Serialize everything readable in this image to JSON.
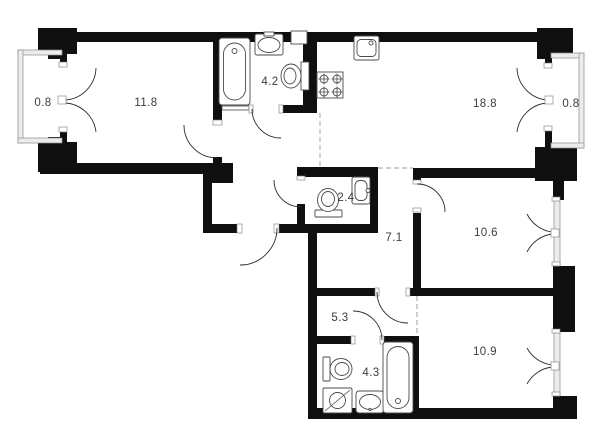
{
  "plan": {
    "type": "apartment-floor-plan",
    "rooms": [
      {
        "name": "balcony-left",
        "area": "0.8"
      },
      {
        "name": "living-room",
        "area": "11.8"
      },
      {
        "name": "bathroom-top",
        "area": "4.2"
      },
      {
        "name": "kitchen-living",
        "area": "18.8"
      },
      {
        "name": "balcony-right",
        "area": "0.8"
      },
      {
        "name": "wc",
        "area": "2.4"
      },
      {
        "name": "hallway",
        "area": "7.1"
      },
      {
        "name": "bedroom-right",
        "area": "10.6"
      },
      {
        "name": "corridor",
        "area": "5.3"
      },
      {
        "name": "bathroom-bottom",
        "area": "4.3"
      },
      {
        "name": "bedroom-bottom",
        "area": "10.9"
      }
    ],
    "fixtures": [
      {
        "name": "bathtub",
        "room": "bathroom-top"
      },
      {
        "name": "wash-basin",
        "room": "bathroom-top"
      },
      {
        "name": "toilet",
        "room": "bathroom-top"
      },
      {
        "name": "vent-shaft",
        "room": "bathroom-top"
      },
      {
        "name": "kitchen-sink",
        "room": "kitchen-living"
      },
      {
        "name": "stove-4-burner",
        "room": "kitchen-living"
      },
      {
        "name": "toilet",
        "room": "wc"
      },
      {
        "name": "wash-basin",
        "room": "wc"
      },
      {
        "name": "toilet",
        "room": "bathroom-bottom"
      },
      {
        "name": "washing-machine",
        "room": "bathroom-bottom"
      },
      {
        "name": "wash-basin",
        "room": "bathroom-bottom"
      },
      {
        "name": "bathtub",
        "room": "bathroom-bottom"
      }
    ],
    "colors": {
      "wall": "#0f0f0f",
      "line": "#2b2b2b",
      "label": "#3c3c3c",
      "window": "#ececec",
      "dashed": "#a0a0a0",
      "background": "#ffffff"
    }
  }
}
